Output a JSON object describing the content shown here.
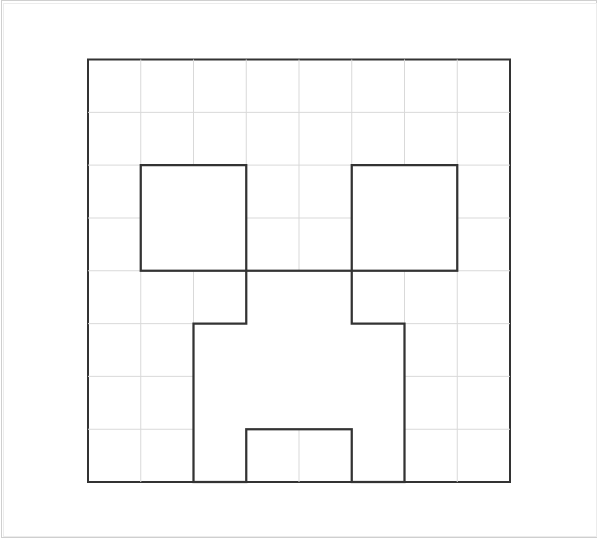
{
  "page": {
    "description": "creeper-face-grid-template",
    "background_color": "#ffffff",
    "frame_outer_color": "#cfcfcf",
    "frame_inner_color": "#ececec"
  },
  "drawing": {
    "canvas": {
      "width": 600,
      "height": 540
    },
    "board": {
      "x": 88,
      "y": 59.5,
      "width": 422,
      "height": 422.5,
      "cells_x": 8,
      "cells_y": 8,
      "outline_color": "#333333",
      "outline_width": 2,
      "fill_color": "#ffffff"
    },
    "grid": {
      "line_color": "#d9d9d9",
      "line_width": 1
    },
    "features": {
      "stroke_color": "#333333",
      "stroke_width": 2.25,
      "fill_color": "#ffffff",
      "left_eye": {
        "col": 1,
        "row": 2,
        "cols": 2,
        "rows": 2
      },
      "right_eye": {
        "col": 5,
        "row": 2,
        "cols": 2,
        "rows": 2
      },
      "mouth_points_cells": [
        [
          3,
          4
        ],
        [
          5,
          4
        ],
        [
          5,
          5
        ],
        [
          6,
          5
        ],
        [
          6,
          8
        ],
        [
          5,
          8
        ],
        [
          5,
          7
        ],
        [
          3,
          7
        ],
        [
          3,
          8
        ],
        [
          2,
          8
        ],
        [
          2,
          5
        ],
        [
          3,
          5
        ]
      ]
    }
  }
}
